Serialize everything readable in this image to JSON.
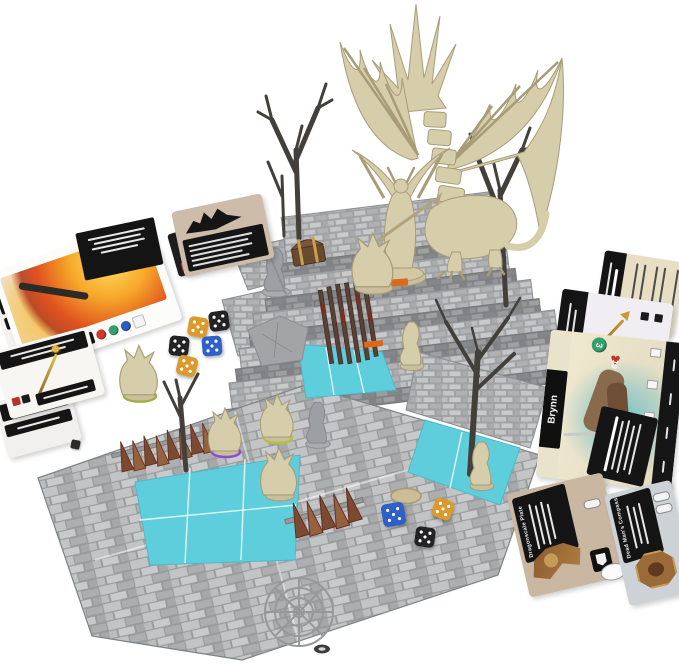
{
  "scene": {
    "type": "board-game-product-photo",
    "subject": "Fantasy dungeon-crawler board game set up with skeletal dragon and demon miniatures on tiered stone-tile boards, hero boards, item cards and dice",
    "background": "#ffffff"
  },
  "hero_board_right": {
    "name": "Brynn",
    "stat_green_value": "3",
    "stat_red_value": "10"
  },
  "cards": {
    "armor_card_title": "Dragonscale Plate",
    "compass_card_title": "Dead Man's Compass"
  },
  "colors": {
    "stone": "#b6b8ba",
    "stone_dark": "#8f9193",
    "water": "#5fcedc",
    "water_light": "#8fe2ec",
    "bone": "#d6cdaa",
    "bone_dark": "#a89c77",
    "tree": "#43403b",
    "rust": "#7b4a31",
    "rust_light": "#96613f",
    "die_orange": "#dd9a2c",
    "die_black": "#232325",
    "die_blue": "#2f5fc9",
    "gem_red": "#cf3a2c",
    "gem_green": "#36a06a",
    "gem_blue": "#2b5cc0",
    "heart_red": "#c03430",
    "marker_orange": "#d96a1e"
  }
}
